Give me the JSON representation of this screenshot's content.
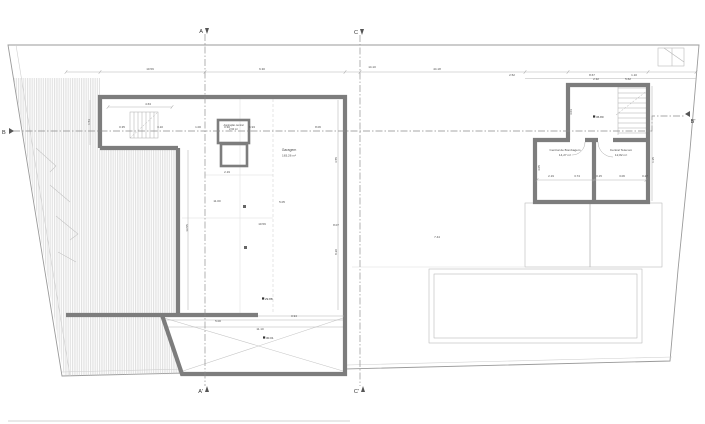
{
  "title": "floor-plan-drawing",
  "colors": {
    "wall": "#7d7d7d",
    "hatch": "#c9c9c9",
    "hatch2": "#bdbdbd",
    "boundary": "#9a9a9a",
    "dash": "#8a8a8a",
    "text": "#4a4a4a"
  },
  "section_markers": {
    "a_top": "A",
    "c_top": "C",
    "a_bottom": "A'",
    "c_bottom": "C'",
    "b_left": "B",
    "b_right": "B'"
  },
  "rooms": {
    "garage": {
      "name": "Garagem",
      "area": "183,26 m²"
    },
    "vac": {
      "name": "Aspiração central",
      "area": "2,90 m²"
    },
    "pump": {
      "name": "Central de Bombagem",
      "area": "14,27 m²"
    },
    "telecom": {
      "name": "Central Telecom",
      "area": "12,82 m²"
    }
  },
  "levels": [
    {
      "x": 599,
      "y": 118,
      "t": "36.80"
    },
    {
      "x": 268,
      "y": 300,
      "t": "29.88"
    },
    {
      "x": 269,
      "y": 339,
      "t": "30.01"
    }
  ],
  "dimensions": [
    {
      "x": 150,
      "y": 70,
      "t": "10.59"
    },
    {
      "x": 262,
      "y": 70,
      "t": "6.30"
    },
    {
      "x": 372,
      "y": 68,
      "t": "14.10"
    },
    {
      "x": 437,
      "y": 70,
      "t": "44.18"
    },
    {
      "x": 512,
      "y": 76,
      "t": "2.52"
    },
    {
      "x": 592,
      "y": 76,
      "t": "8.67"
    },
    {
      "x": 634,
      "y": 76,
      "t": "1.10"
    },
    {
      "x": 148,
      "y": 105,
      "t": "4.63"
    },
    {
      "x": 122,
      "y": 128,
      "t": "0.35"
    },
    {
      "x": 160,
      "y": 128,
      "t": "3.10"
    },
    {
      "x": 198,
      "y": 128,
      "t": "1.00"
    },
    {
      "x": 227,
      "y": 128,
      "t": "0.30"
    },
    {
      "x": 252,
      "y": 128,
      "t": "6.93"
    },
    {
      "x": 318,
      "y": 128,
      "t": "8.06"
    },
    {
      "x": 227,
      "y": 173,
      "t": "2.19"
    },
    {
      "x": 217,
      "y": 202,
      "t": "11.00"
    },
    {
      "x": 282,
      "y": 203,
      "t": "5.05"
    },
    {
      "x": 262,
      "y": 225,
      "t": "10.59"
    },
    {
      "x": 336,
      "y": 226,
      "t": "8.07"
    },
    {
      "x": 218,
      "y": 322,
      "t": "5.00"
    },
    {
      "x": 260,
      "y": 330,
      "t": "11.10"
    },
    {
      "x": 294,
      "y": 317,
      "t": "0.94"
    },
    {
      "x": 437,
      "y": 238,
      "t": "7.44"
    },
    {
      "x": 551,
      "y": 177,
      "t": "2.19"
    },
    {
      "x": 577,
      "y": 177,
      "t": "3.74"
    },
    {
      "x": 599,
      "y": 177,
      "t": "0.15"
    },
    {
      "x": 622,
      "y": 177,
      "t": "3.06"
    },
    {
      "x": 645,
      "y": 177,
      "t": "0.27"
    },
    {
      "x": 596,
      "y": 80,
      "t": "2.32"
    },
    {
      "x": 628,
      "y": 80,
      "t": "5.62"
    },
    {
      "x": 188,
      "y": 228,
      "t": "13.55",
      "rot": -90
    },
    {
      "x": 337,
      "y": 160,
      "t": "3.55",
      "rot": -90
    },
    {
      "x": 337,
      "y": 252,
      "t": "8.20",
      "rot": -90
    },
    {
      "x": 540,
      "y": 168,
      "t": "4.05",
      "rot": -90
    },
    {
      "x": 654,
      "y": 160,
      "t": "1.35",
      "rot": -90
    },
    {
      "x": 90,
      "y": 122,
      "t": "1.53",
      "rot": -90
    },
    {
      "x": 572,
      "y": 112,
      "t": "3.03",
      "rot": -90
    }
  ]
}
